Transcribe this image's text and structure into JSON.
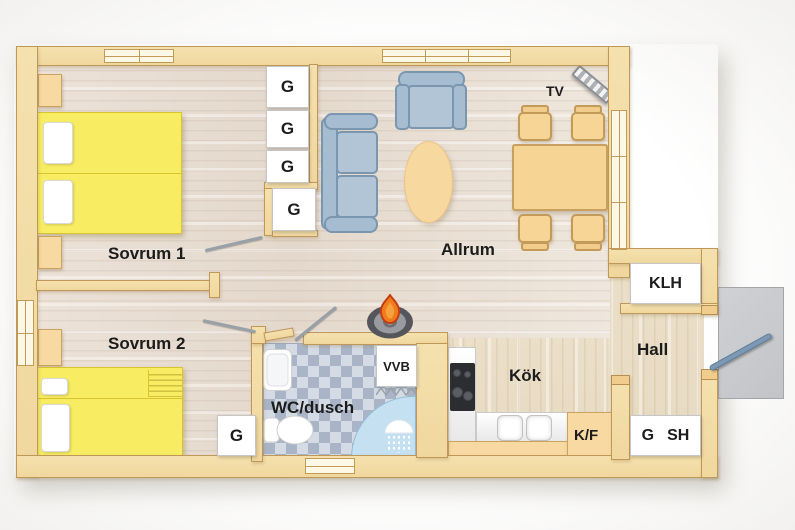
{
  "rooms": {
    "sovrum1": "Sovrum 1",
    "sovrum2": "Sovrum 2",
    "allrum": "Allrum",
    "kok": "Kök",
    "hall": "Hall",
    "wc": "WC/dusch"
  },
  "storage": {
    "g1": "G",
    "g2": "G",
    "g3": "G",
    "g4": "G",
    "g_corridor": "G",
    "klh": "KLH",
    "vvb": "VVB",
    "kf": "K/F",
    "g_hall": "G",
    "sh": "SH"
  },
  "appliances": {
    "tv": "TV"
  },
  "colors": {
    "wall_fill": "#f5e1ae",
    "wall_edge": "#bf9758",
    "bed_yellow": "#f7ec62",
    "furn_tan": "#f8d9a2",
    "sofa_blue": "#a6bcd1",
    "sofa_edge": "#7b96af",
    "tile_dark": "#a9b5c6",
    "tile_light": "#d5dbe4",
    "shower_blue": "#c5e0f1",
    "porch_gray": "#c9cbce",
    "flame_orange": "#f07c1e",
    "ink": "#1c1c1c"
  }
}
